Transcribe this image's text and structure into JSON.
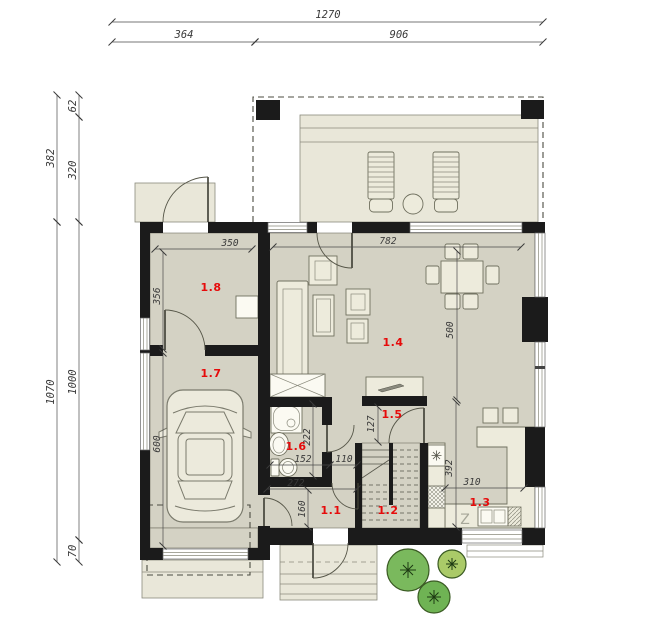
{
  "rooms": {
    "r11": "1.1",
    "r12": "1.2",
    "r13": "1.3",
    "r14": "1.4",
    "r15": "1.5",
    "r16": "1.6",
    "r17": "1.7",
    "r18": "1.8"
  },
  "dims": {
    "overall_width": "1270",
    "left_section": "364",
    "right_section": "906",
    "upper_depth": "382",
    "terrace_inset": "62",
    "terrace_depth": "320",
    "lower_depth": "1070",
    "house_depth": "1000",
    "front_offset": "70",
    "utility_width": "350",
    "utility_depth": "356",
    "living_width": "782",
    "living_depth": "500",
    "garage_length": "600",
    "bath_depth": "222",
    "bath_width": "152",
    "passage_width": "110",
    "hall_width": "272",
    "hall_depth": "160",
    "corridor_width": "127",
    "kitchen_depth": "392",
    "kitchen_width": "310"
  },
  "labels": {
    "sink_marker": "Z"
  },
  "colors": {
    "wall": "#1b1b1b",
    "floor": "#d4d2c4",
    "outdoor": "#e9e7d9",
    "furniture": "#edebdc",
    "room_label_red": "#e60b0b",
    "dimension_text": "#3a3a3a",
    "tree_green": "#7ab95d",
    "tree_light_green": "#aaca68"
  }
}
